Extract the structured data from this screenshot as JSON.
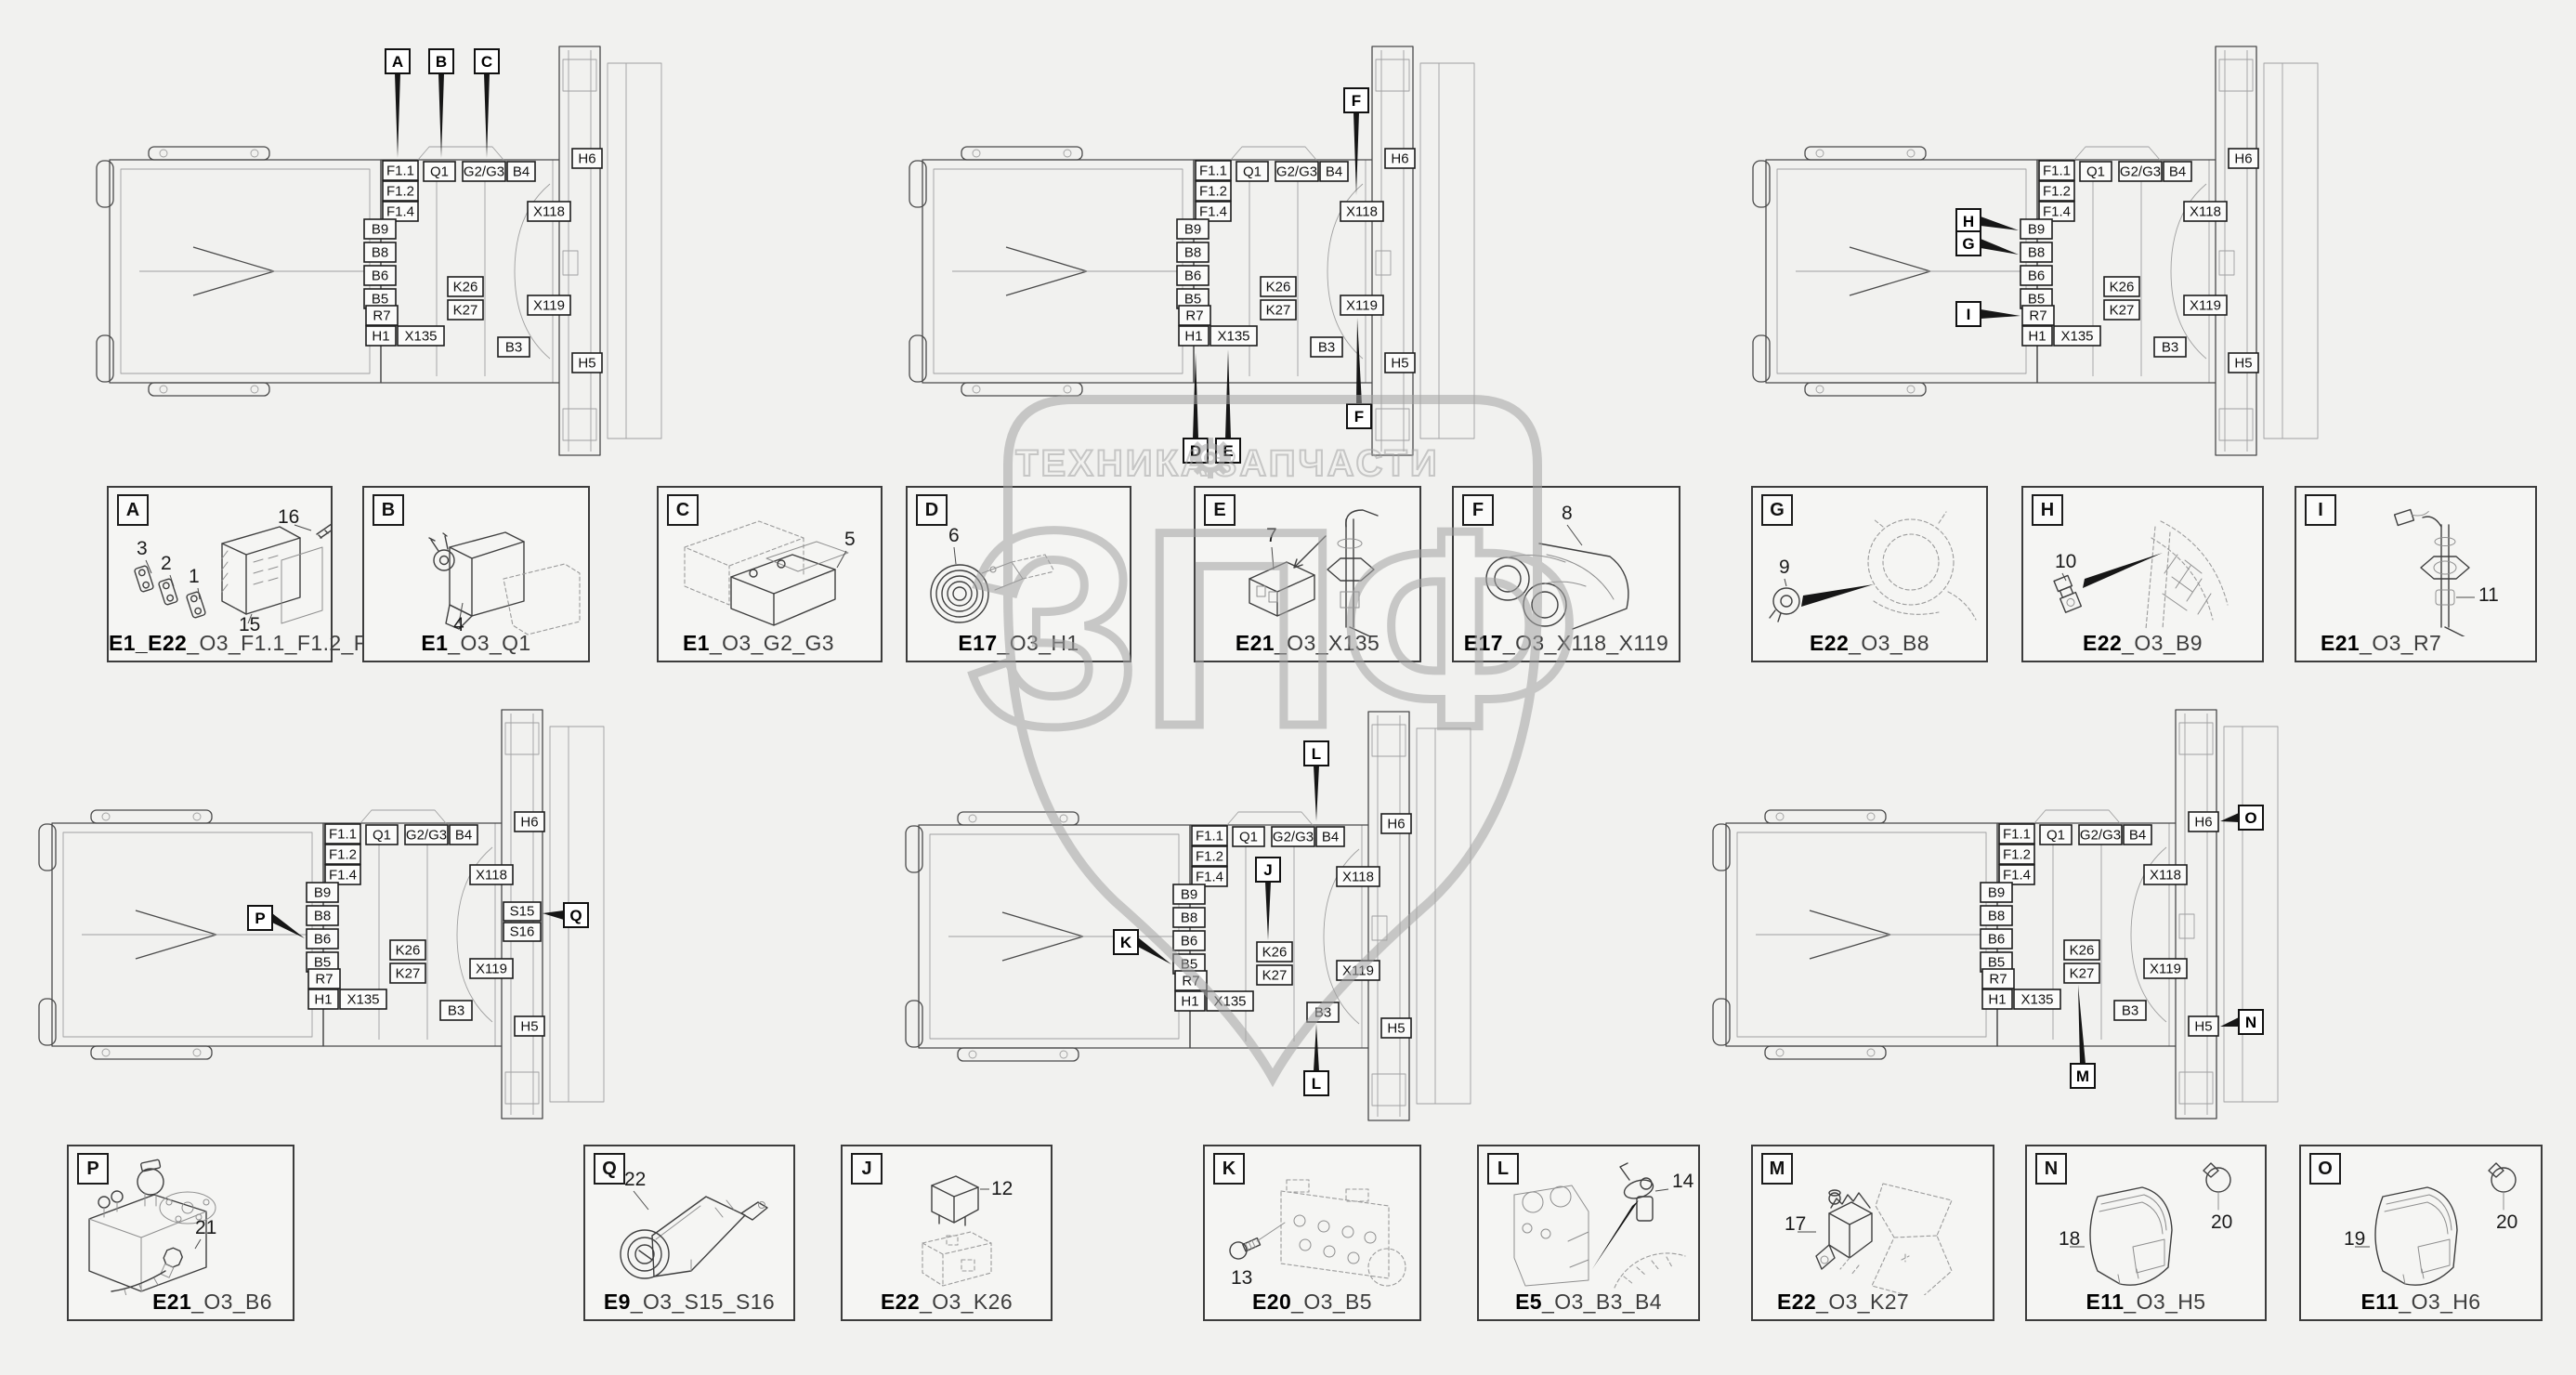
{
  "palette": {
    "background": "#f1f1ef",
    "line": "#3f3f3f",
    "watermark": "#a3a3a3"
  },
  "watermark": {
    "left_text": "ТЕХНИКА",
    "right_text": "ЗАПЧАСТИ",
    "big_text": "ЗПФ"
  },
  "chassis_labels": {
    "f11": "F1.1",
    "f12": "F1.2",
    "f14": "F1.4",
    "q1": "Q1",
    "g2g3": "G2/G3",
    "b4": "B4",
    "h6": "H6",
    "x118": "X118",
    "b9": "B9",
    "b8": "B8",
    "b6": "B6",
    "b5": "B5",
    "k26": "K26",
    "k27": "K27",
    "x119": "X119",
    "r7": "R7",
    "h1": "H1",
    "x135": "X135",
    "b3": "B3",
    "h5": "H5",
    "s15": "S15",
    "s16": "S16"
  },
  "diagrams": [
    {
      "id": "top-left",
      "callouts": [
        "A",
        "B",
        "C"
      ]
    },
    {
      "id": "top-middle",
      "callouts": [
        "F",
        "D",
        "E",
        "F"
      ]
    },
    {
      "id": "top-right",
      "callouts": [
        "H",
        "G",
        "I"
      ]
    },
    {
      "id": "bottom-left",
      "callouts": [
        "P",
        "Q"
      ]
    },
    {
      "id": "bottom-middle",
      "callouts": [
        "L",
        "J",
        "K",
        "L"
      ]
    },
    {
      "id": "bottom-right",
      "callouts": [
        "O",
        "N",
        "M"
      ]
    }
  ],
  "detail_boxes": [
    {
      "letter": "A",
      "caption_bold": "E1_E22",
      "caption_rest": "_O3_F1.1_F1.2_F1.4",
      "parts": [
        "3",
        "2",
        "1",
        "15",
        "16"
      ]
    },
    {
      "letter": "B",
      "caption_bold": "E1",
      "caption_rest": "_O3_Q1",
      "parts": [
        "4"
      ]
    },
    {
      "letter": "C",
      "caption_bold": "E1",
      "caption_rest": "_O3_G2_G3",
      "parts": [
        "5"
      ]
    },
    {
      "letter": "D",
      "caption_bold": "E17",
      "caption_rest": "_O3_H1",
      "parts": [
        "6"
      ]
    },
    {
      "letter": "E",
      "caption_bold": "E21",
      "caption_rest": "_O3_X135",
      "parts": [
        "7"
      ]
    },
    {
      "letter": "F",
      "caption_bold": "E17",
      "caption_rest": "_O3_X118_X119",
      "parts": [
        "8"
      ]
    },
    {
      "letter": "G",
      "caption_bold": "E22",
      "caption_rest": "_O3_B8",
      "parts": [
        "9"
      ]
    },
    {
      "letter": "H",
      "caption_bold": "E22",
      "caption_rest": "_O3_B9",
      "parts": [
        "10"
      ]
    },
    {
      "letter": "I",
      "caption_bold": "E21",
      "caption_rest": "_O3_R7",
      "parts": [
        "11"
      ]
    },
    {
      "letter": "P",
      "caption_bold": "E21",
      "caption_rest": "_O3_B6",
      "parts": [
        "21"
      ]
    },
    {
      "letter": "Q",
      "caption_bold": "E9",
      "caption_rest": "_O3_S15_S16",
      "parts": [
        "22"
      ]
    },
    {
      "letter": "J",
      "caption_bold": "E22",
      "caption_rest": "_O3_K26",
      "parts": [
        "12"
      ]
    },
    {
      "letter": "K",
      "caption_bold": "E20",
      "caption_rest": "_O3_B5",
      "parts": [
        "13"
      ]
    },
    {
      "letter": "L",
      "caption_bold": "E5",
      "caption_rest": "_O3_B3_B4",
      "parts": [
        "14"
      ]
    },
    {
      "letter": "M",
      "caption_bold": "E22",
      "caption_rest": "_O3_K27",
      "parts": [
        "17"
      ]
    },
    {
      "letter": "N",
      "caption_bold": "E11",
      "caption_rest": "_O3_H5",
      "parts": [
        "18",
        "20"
      ]
    },
    {
      "letter": "O",
      "caption_bold": "E11",
      "caption_rest": "_O3_H6",
      "parts": [
        "19",
        "20"
      ]
    }
  ]
}
